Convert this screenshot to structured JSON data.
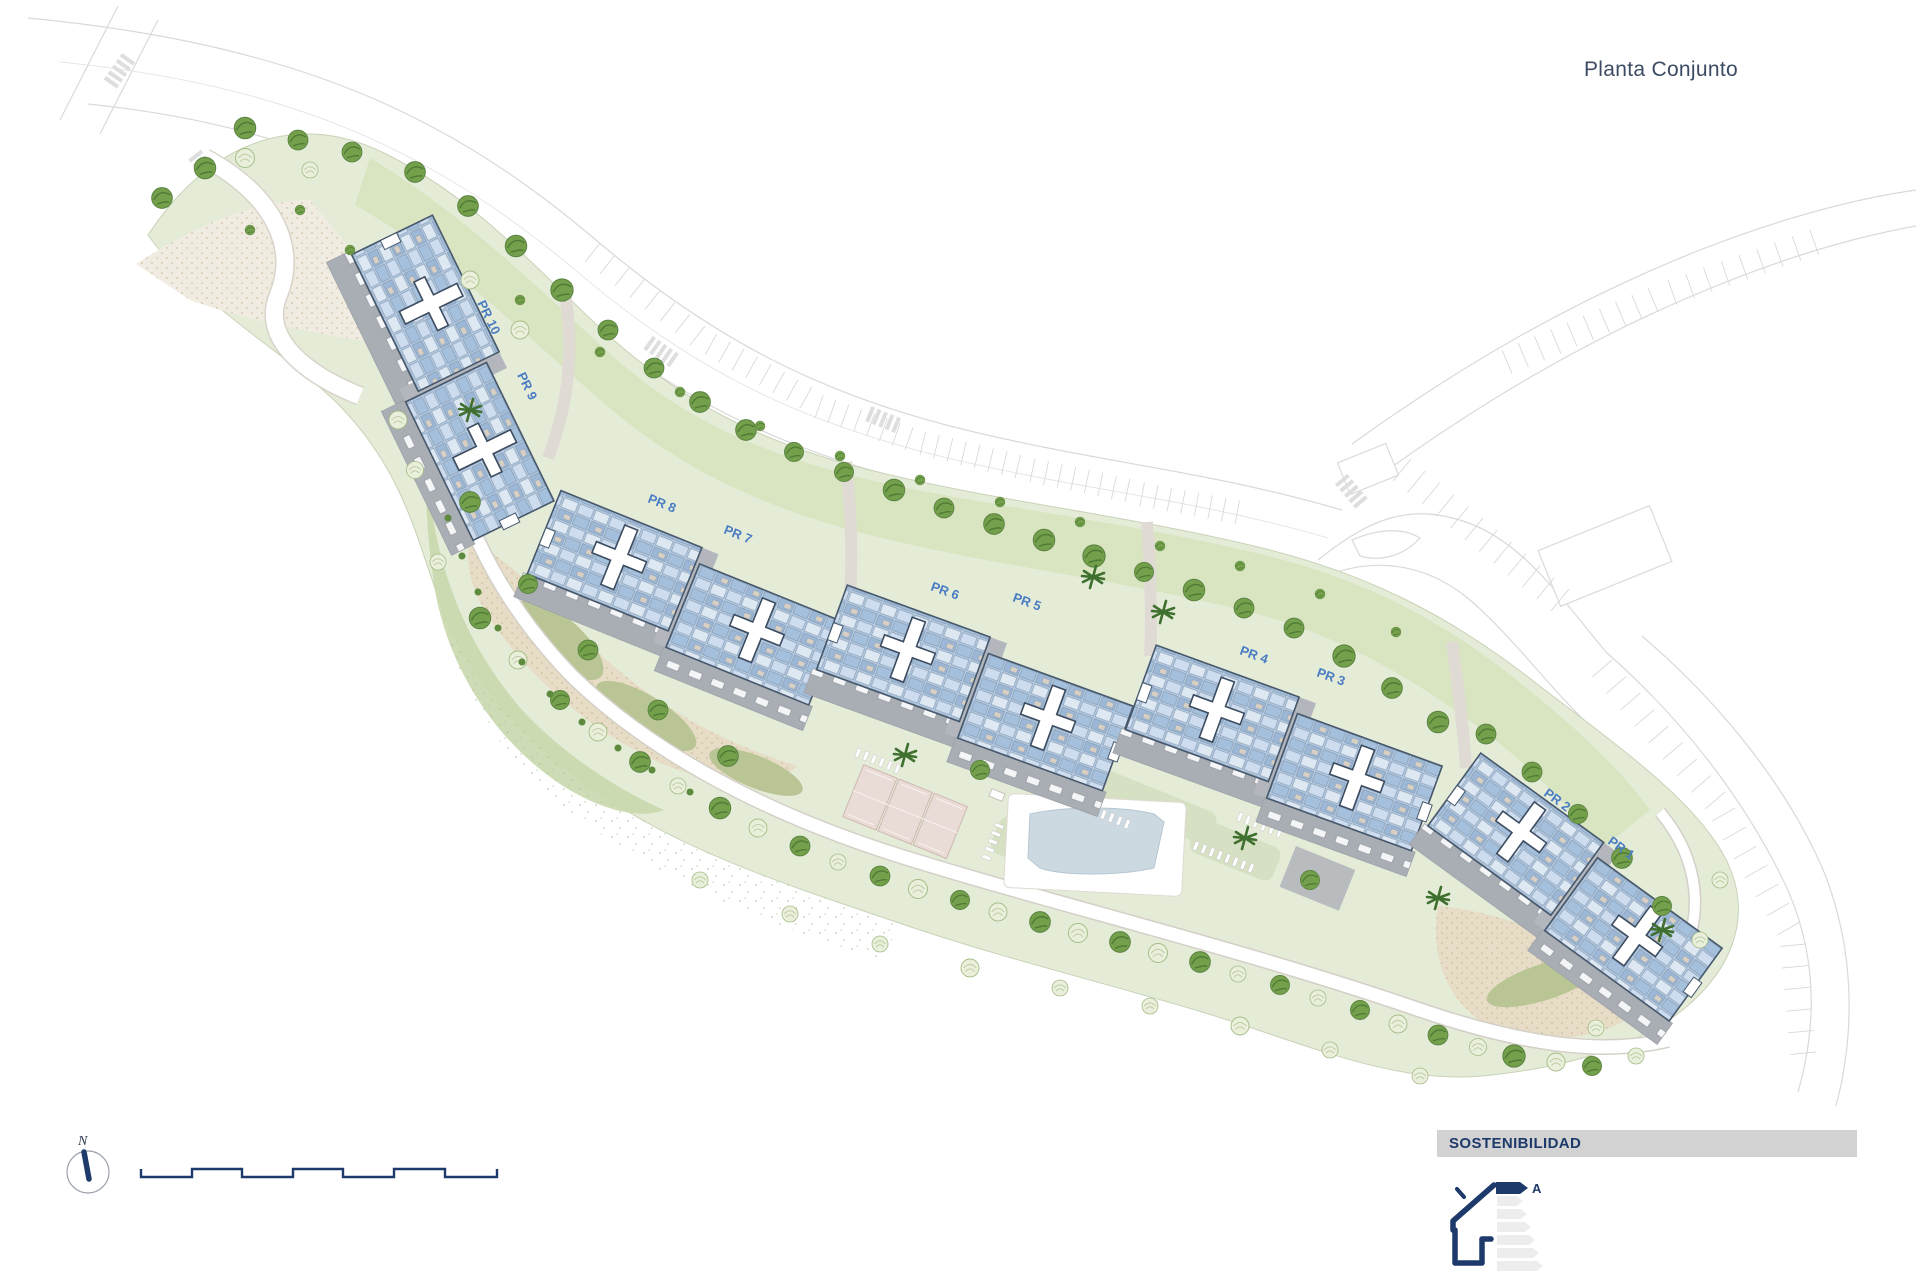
{
  "title": "Planta Conjunto",
  "plan": {
    "building_labels": [
      "PR 1",
      "PR 2",
      "PR 3",
      "PR 4",
      "PR 5",
      "PR 6",
      "PR 7",
      "PR 8",
      "PR 9",
      "PR 10"
    ]
  },
  "legend": {
    "north": "N",
    "icons": {
      "compass": "north-arrow",
      "scale": "graphic-scale-bar"
    }
  },
  "sustainability": {
    "header": "SOSTENIBILIDAD",
    "energy_class": "A",
    "icon": "energy-efficiency-house"
  },
  "colors": {
    "label_blue": "#4a7cc2",
    "navy": "#1d3a6a",
    "building_fill": "#b7cce3",
    "site_green": "#e4ecd8",
    "band_green": "#d9e4c1",
    "pool_blue": "#ccd9e1",
    "sand": "#e7ddc6",
    "header_bar_gray": "#d2d2d2"
  }
}
